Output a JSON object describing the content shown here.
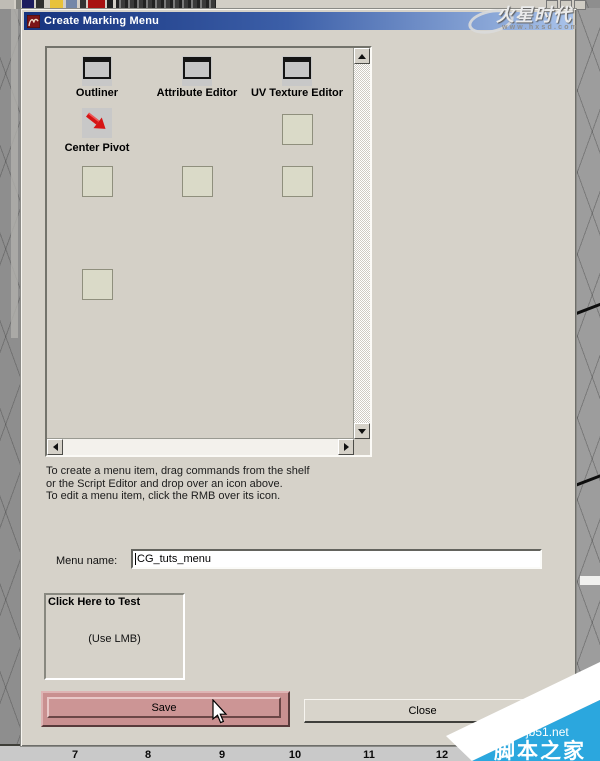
{
  "window": {
    "title": "Create Marking Menu"
  },
  "shelf": {
    "items": [
      {
        "label": "Outliner",
        "icon": "window-icon"
      },
      {
        "label": "Attribute Editor",
        "icon": "window-icon"
      },
      {
        "label": "UV Texture Editor",
        "icon": "window-icon"
      },
      {
        "label": "Center Pivot",
        "icon": "red-arrow-icon"
      }
    ]
  },
  "instructions": {
    "lines": [
      "To create a menu item, drag commands from the shelf",
      "or the Script Editor and drop over an icon above.",
      "To edit a menu item, click the RMB over its icon."
    ]
  },
  "menu_name": {
    "label": "Menu name:",
    "value": "CG_tuts_menu"
  },
  "test_area": {
    "title": "Click Here to Test",
    "hint": "(Use LMB)"
  },
  "buttons": {
    "save": "Save",
    "close": "Close"
  },
  "timeline": {
    "ticks": [
      "7",
      "8",
      "9",
      "10",
      "11",
      "12",
      "13",
      "14"
    ]
  },
  "watermarks": {
    "top_right": {
      "brand": "火星时代",
      "url": "www.hxsd.com"
    },
    "bottom_right": {
      "site": "jb51.net",
      "name": "脚本之家"
    }
  },
  "colors": {
    "titlebar_left": "#16337e",
    "titlebar_right": "#a9c3ea",
    "save_button": "#cc9595",
    "dialog_face": "#d6d2c9",
    "empty_slot": "#dadac8",
    "watermark_blue": "#2ba7de"
  }
}
